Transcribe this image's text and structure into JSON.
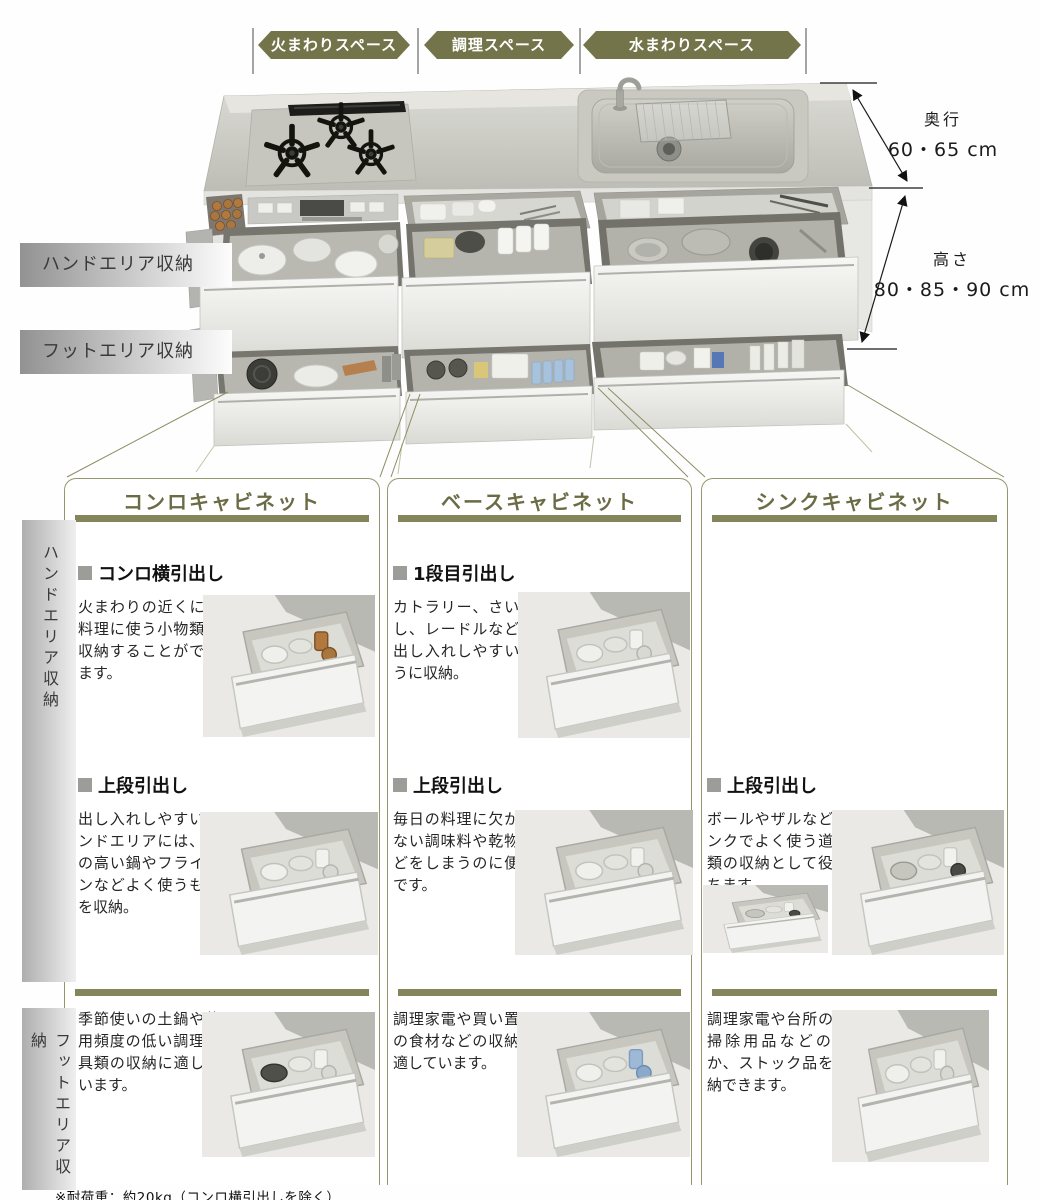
{
  "colors": {
    "accent_olive": "#74744b",
    "bar_olive": "#85855b",
    "header_text": "#6b6b45"
  },
  "top_diagram": {
    "space_labels": [
      "火まわりスペース",
      "調理スペース",
      "水まわりスペース"
    ],
    "hand_area_label": "ハンドエリア収納",
    "foot_area_label": "フットエリア収納",
    "depth": {
      "label": "奥行",
      "value": "60・65 cm"
    },
    "height": {
      "label": "高さ",
      "value": "80・85・90 cm"
    }
  },
  "grid": {
    "hand_side_label": "ハンドエリア収納",
    "foot_side_label": "フットエリア収納",
    "columns": [
      {
        "header": "コンロキャビネット",
        "cells": {
          "row1": {
            "title": "コンロ横引出し",
            "body": "火まわりの近くに、料理に使う小物類を収納することができます。"
          },
          "row2": {
            "title": "上段引出し",
            "body": "出し入れしやすいハンドエリアには、背の高い鍋やフライパンなどよく使うものを収納。"
          },
          "row3": {
            "body": "季節使いの土鍋や使用頻度の低い調理道具類の収納に適しています。"
          }
        }
      },
      {
        "header": "ベースキャビネット",
        "cells": {
          "row1": {
            "title": "1段目引出し",
            "body": "カトラリー、さいばし、レードルなどを出し入れしやすいように収納。"
          },
          "row2": {
            "title": "上段引出し",
            "body": "毎日の料理に欠かせない調味料や乾物などをしまうのに便利です。"
          },
          "row3": {
            "body": "調理家電や買い置きの食材などの収納に適しています。"
          }
        }
      },
      {
        "header": "シンクキャビネット",
        "cells": {
          "row2": {
            "title": "上段引出し",
            "body": "ボールやザルなどシンクでよく使う道具類の収納として役立ちます。"
          },
          "row3": {
            "body": "調理家電や台所のお掃除用品などのほか、ストック品を収納できます。"
          }
        }
      }
    ]
  },
  "footnote": "※耐荷重：約20kg（コンロ横引出しを除く）"
}
